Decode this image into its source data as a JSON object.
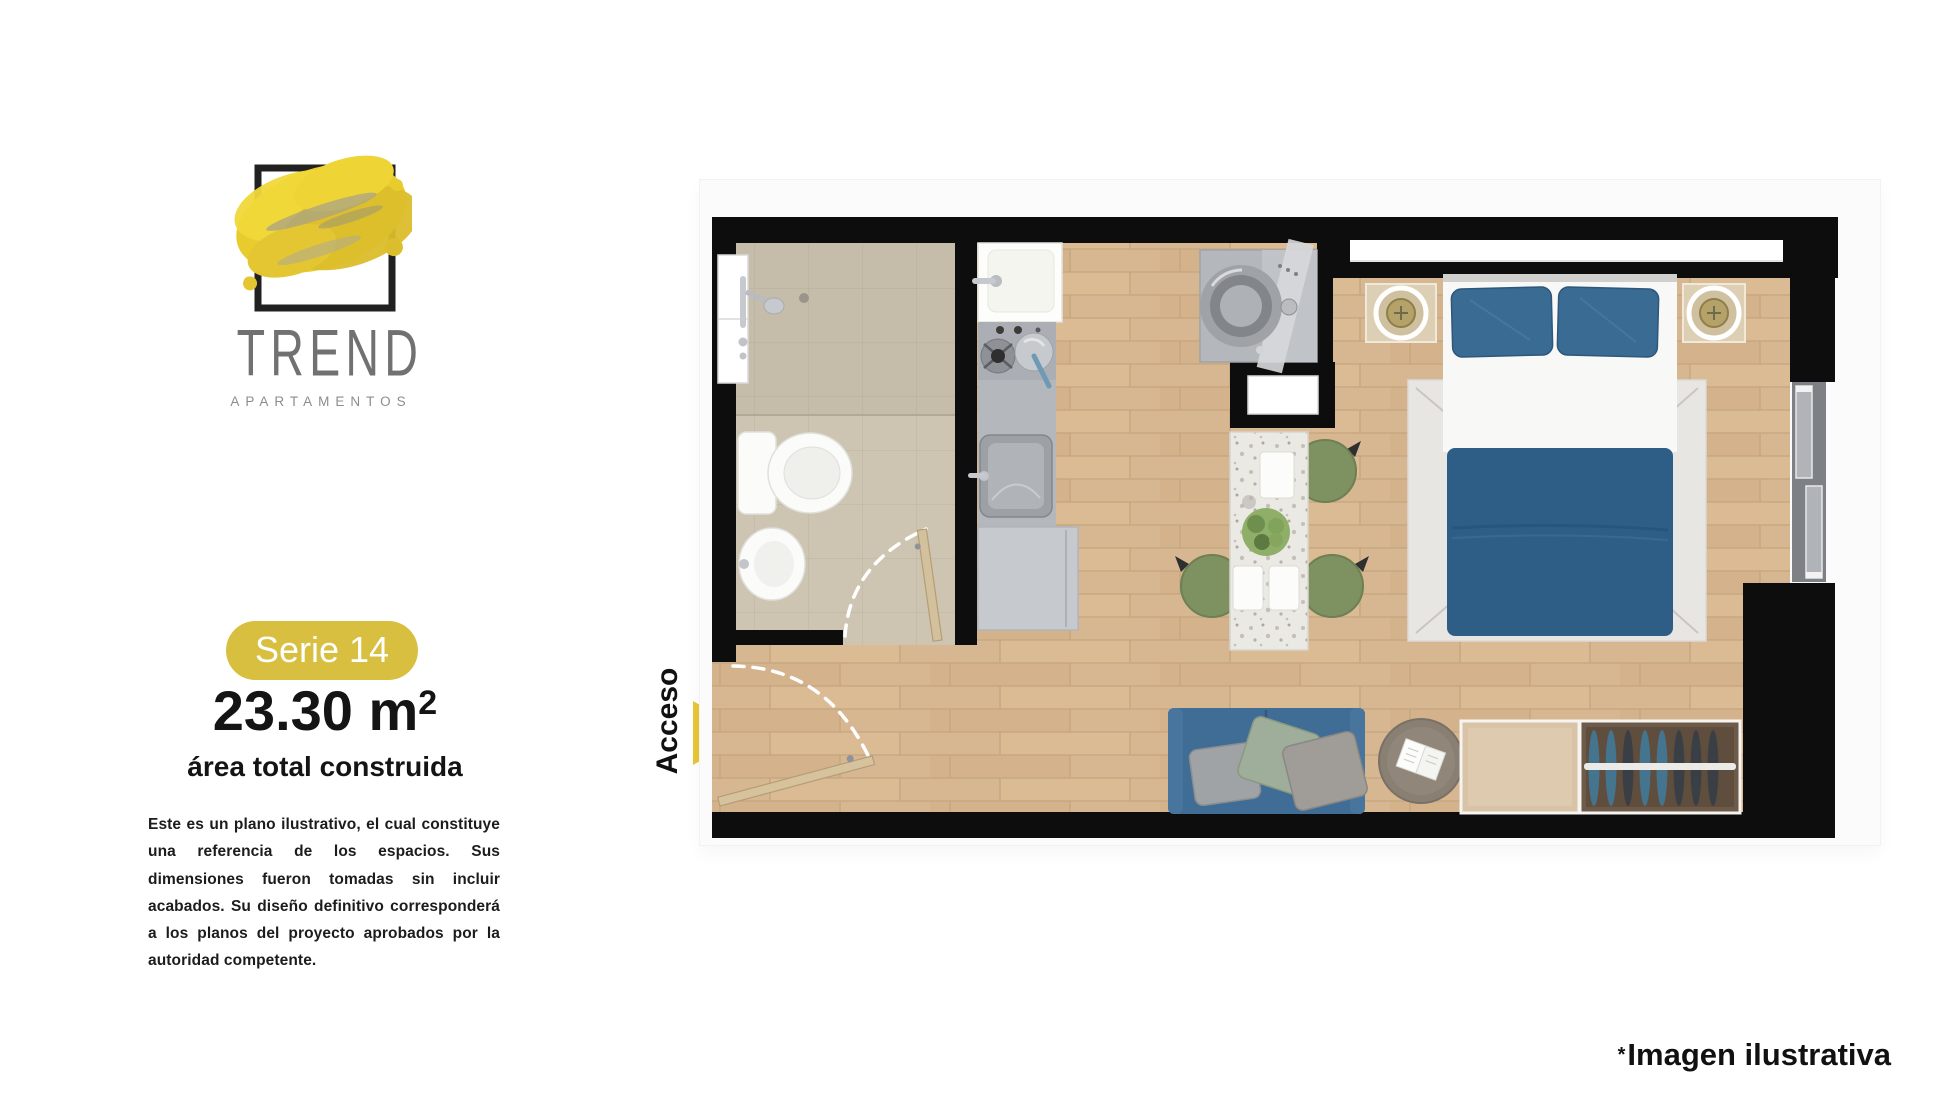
{
  "brand": {
    "wordmark": "TREND",
    "subtitle": "APARTAMENTOS"
  },
  "unit": {
    "badge": "Serie 14",
    "area_value": "23.30 m",
    "area_superscript": "2",
    "area_caption": "área total construida"
  },
  "disclaimer": "Este es un plano ilustrativo, el cual constituye una referencia de los espacios. Sus dimensiones fueron tomadas sin incluir acabados. Su diseño definitivo corresponderá a los planos del proyecto aprobados por la autoridad competente.",
  "floorplan": {
    "access_label": "Acceso",
    "footnote_star": "*",
    "footnote_text": "Imagen ilustrativa",
    "elements": [
      "bathroom",
      "shower",
      "toilet",
      "bidet-sink",
      "bathroom-door",
      "kitchen-sink",
      "stove",
      "utility-sink",
      "kitchen-cabinet",
      "washing-machine",
      "pass-window",
      "bedroom-window",
      "left-window",
      "bed",
      "pillows",
      "duvet",
      "rug",
      "nightstand-left",
      "nightstand-right",
      "dining-table",
      "dining-chairs",
      "plant",
      "sofa",
      "cushions",
      "ottoman",
      "book",
      "closet",
      "hanging-clothes",
      "sliding-door",
      "entry-door"
    ]
  },
  "colors": {
    "accent_yellow": "#d9bf40",
    "arrow_yellow": "#e7c733",
    "logo_yellow": "#e8cc2e",
    "wall_black": "#0d0d0d",
    "wood_floor": "#d7b791",
    "tile_beige": "#cdc4b2",
    "bed_blue": "#2e5e85",
    "pillow_blue": "#3a6b92",
    "sofa_blue": "#3f6d96",
    "chair_green": "#7e9161",
    "text_dark": "#141414",
    "text_gray": "#717171"
  }
}
